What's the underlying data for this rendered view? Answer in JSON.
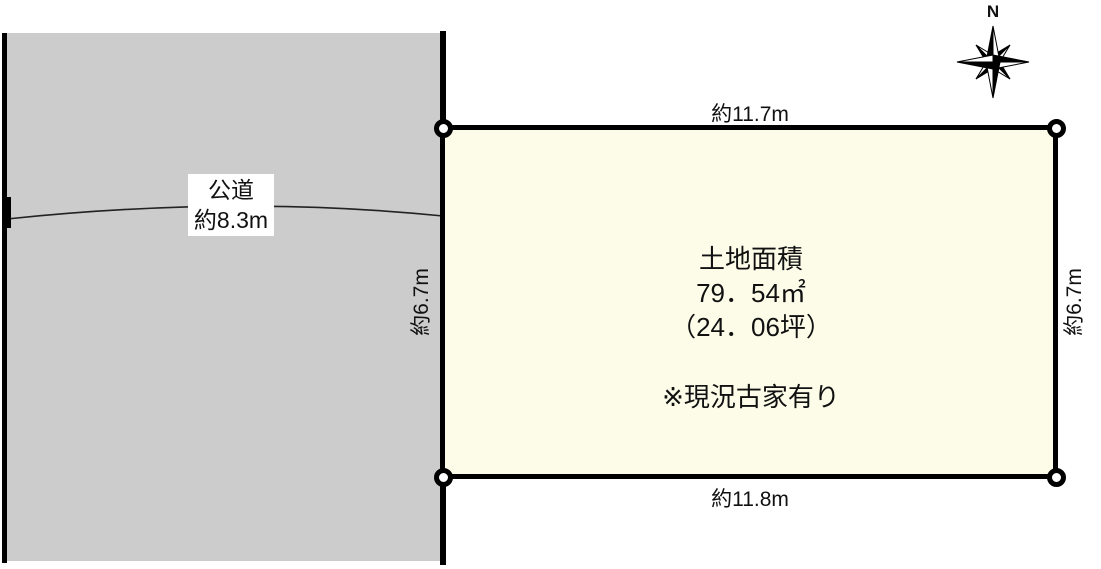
{
  "compass": {
    "north_label": "N"
  },
  "road": {
    "name": "公道",
    "width_label": "約8.3m"
  },
  "plot": {
    "dimensions": {
      "top": "約11.7m",
      "bottom": "約11.8m",
      "left": "約6.7m",
      "right": "約6.7m"
    },
    "area_title": "土地面積",
    "area_sqm": "79．54㎡",
    "area_tsubo": "（24．06坪）",
    "note": "※現況古家有り"
  },
  "colors": {
    "road_fill": "#cccccc",
    "plot_fill": "#fcfce9",
    "line": "#000000"
  }
}
